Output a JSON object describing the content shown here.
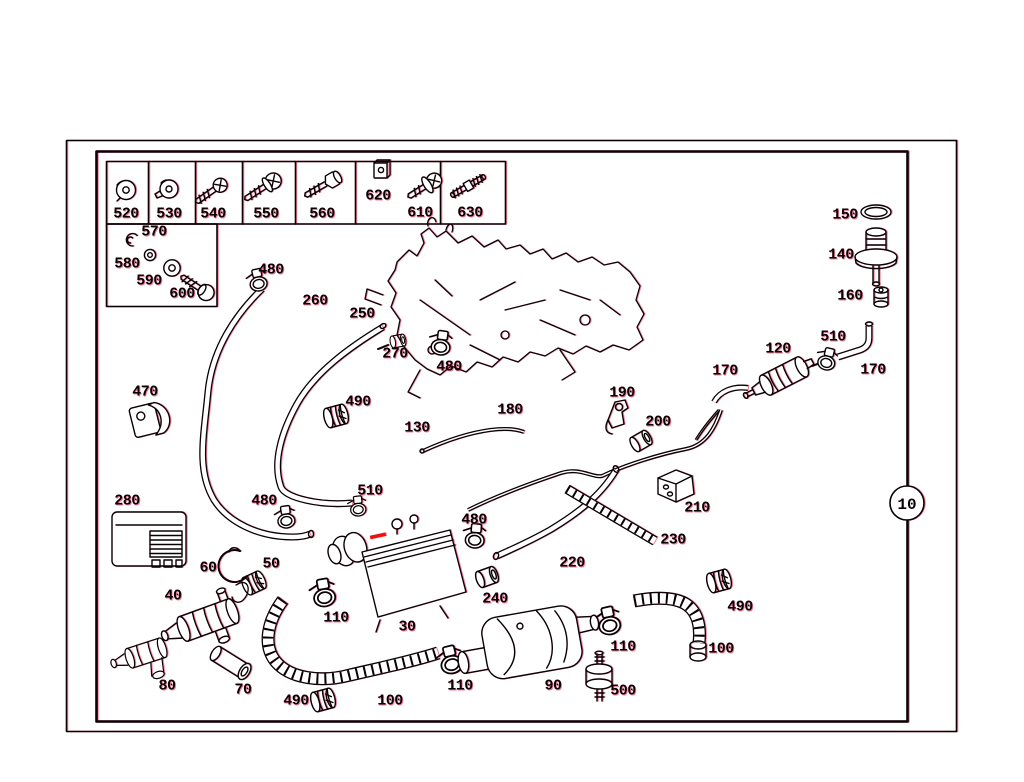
{
  "diagram": {
    "callout": {
      "label": "10"
    },
    "accent": {
      "line_color": "#0a0004",
      "fringe_color": "#e1144 6",
      "highlight_color": "#ee1111",
      "background": "#ffffff"
    },
    "part_labels": [
      {
        "text": "520",
        "x": 126,
        "y": 214
      },
      {
        "text": "530",
        "x": 169,
        "y": 214
      },
      {
        "text": "540",
        "x": 213,
        "y": 214
      },
      {
        "text": "550",
        "x": 266,
        "y": 214
      },
      {
        "text": "560",
        "x": 322,
        "y": 214
      },
      {
        "text": "620",
        "x": 378,
        "y": 196
      },
      {
        "text": "610",
        "x": 420,
        "y": 213
      },
      {
        "text": "630",
        "x": 470,
        "y": 213
      },
      {
        "text": "570",
        "x": 154,
        "y": 232
      },
      {
        "text": "580",
        "x": 127,
        "y": 264
      },
      {
        "text": "590",
        "x": 149,
        "y": 281
      },
      {
        "text": "600",
        "x": 182,
        "y": 294
      },
      {
        "text": "480",
        "x": 271,
        "y": 270
      },
      {
        "text": "260",
        "x": 315,
        "y": 301
      },
      {
        "text": "250",
        "x": 362,
        "y": 314
      },
      {
        "text": "270",
        "x": 395,
        "y": 354
      },
      {
        "text": "480",
        "x": 449,
        "y": 367
      },
      {
        "text": "150",
        "x": 845,
        "y": 215
      },
      {
        "text": "140",
        "x": 841,
        "y": 255
      },
      {
        "text": "160",
        "x": 850,
        "y": 296
      },
      {
        "text": "510",
        "x": 833,
        "y": 337
      },
      {
        "text": "120",
        "x": 778,
        "y": 349
      },
      {
        "text": "170",
        "x": 725,
        "y": 371
      },
      {
        "text": "170",
        "x": 873,
        "y": 370
      },
      {
        "text": "190",
        "x": 622,
        "y": 393
      },
      {
        "text": "200",
        "x": 658,
        "y": 422
      },
      {
        "text": "180",
        "x": 510,
        "y": 410
      },
      {
        "text": "130",
        "x": 417,
        "y": 428
      },
      {
        "text": "470",
        "x": 145,
        "y": 392
      },
      {
        "text": "490",
        "x": 358,
        "y": 402
      },
      {
        "text": "280",
        "x": 127,
        "y": 501
      },
      {
        "text": "480",
        "x": 264,
        "y": 501
      },
      {
        "text": "510",
        "x": 370,
        "y": 491
      },
      {
        "text": "210",
        "x": 697,
        "y": 508
      },
      {
        "text": "230",
        "x": 673,
        "y": 540
      },
      {
        "text": "220",
        "x": 572,
        "y": 563
      },
      {
        "text": "480",
        "x": 474,
        "y": 520
      },
      {
        "text": "60",
        "x": 208,
        "y": 568
      },
      {
        "text": "50",
        "x": 271,
        "y": 564
      },
      {
        "text": "40",
        "x": 173,
        "y": 596
      },
      {
        "text": "110",
        "x": 336,
        "y": 618
      },
      {
        "text": "30",
        "x": 407,
        "y": 627
      },
      {
        "text": "240",
        "x": 495,
        "y": 599
      },
      {
        "text": "80",
        "x": 167,
        "y": 686
      },
      {
        "text": "70",
        "x": 243,
        "y": 690
      },
      {
        "text": "490",
        "x": 296,
        "y": 701
      },
      {
        "text": "100",
        "x": 390,
        "y": 701
      },
      {
        "text": "110",
        "x": 460,
        "y": 686
      },
      {
        "text": "90",
        "x": 553,
        "y": 686
      },
      {
        "text": "500",
        "x": 623,
        "y": 691
      },
      {
        "text": "110",
        "x": 623,
        "y": 647
      },
      {
        "text": "100",
        "x": 721,
        "y": 649
      },
      {
        "text": "490",
        "x": 740,
        "y": 607
      }
    ]
  }
}
